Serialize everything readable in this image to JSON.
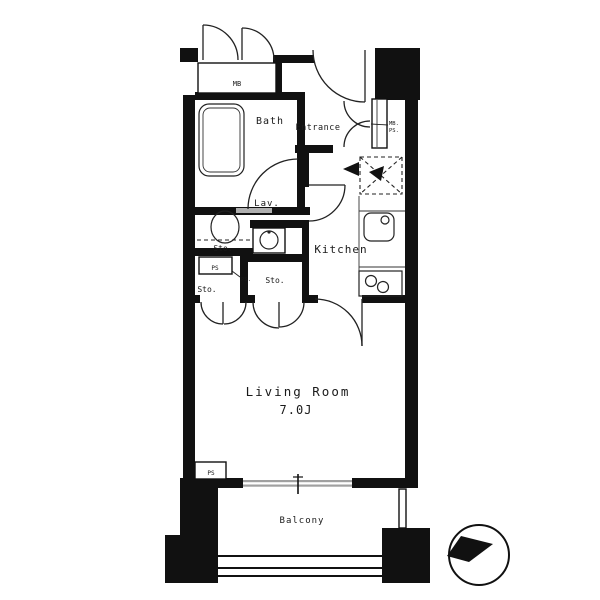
{
  "plan": {
    "rooms": {
      "bath": "Bath",
      "entrance": "Entrance",
      "lavatory": "Lav.",
      "kitchen": "Kitchen",
      "living_room": "Living Room",
      "living_room_size": "7.0J",
      "balcony": "Balcony",
      "storage_lav": "Sto.",
      "storage_left": "Sto.",
      "storage_mid": "Sto."
    },
    "notes": {
      "outdoor_box": "MB",
      "entrance_box_l1": "MB.",
      "entrance_box_l2": "PS.",
      "lav_box_note": "PS.",
      "pipe_space_left": "PS",
      "pipe_space_south": "PS"
    },
    "fixtures": {
      "bathtub": "bathtub",
      "toilet": "toilet",
      "washbasin": "washbasin",
      "sink": "kitchen-sink",
      "stove": "gas-stove-2-burner",
      "refrigerator": "refrigerator-space"
    },
    "compass": "north-arrow-compass",
    "colors": {
      "line": "#1a1a1a",
      "window": "#a0a0a0",
      "background": "#ffffff"
    }
  }
}
